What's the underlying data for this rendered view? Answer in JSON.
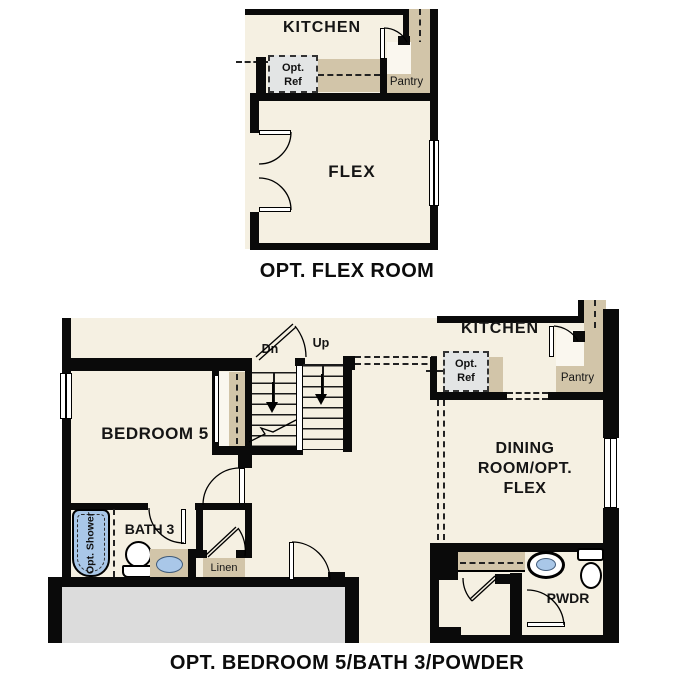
{
  "colors": {
    "floor": "#f5f0e2",
    "cabinet_tan": "#d2c5a9",
    "garage_gray": "#dcdcdc",
    "ref_box_gray": "#e3e5e5",
    "fixture_blue": "#a9c7e8",
    "wall": "#0a0a0a"
  },
  "flex_plan": {
    "kitchen_label": "KITCHEN",
    "opt_ref_line1": "Opt.",
    "opt_ref_line2": "Ref",
    "pantry_label": "Pantry",
    "flex_label": "FLEX",
    "caption": "OPT. FLEX ROOM"
  },
  "bedroom5_plan": {
    "kitchen_label": "KITCHEN",
    "opt_ref_line1": "Opt.",
    "opt_ref_line2": "Ref",
    "pantry_label": "Pantry",
    "bedroom5_label": "BEDROOM 5",
    "stairs_down_label": "Dn",
    "stairs_up_label": "Up",
    "dining_label_line1": "DINING",
    "dining_label_line2": "ROOM/OPT.",
    "dining_label_line3": "FLEX",
    "bath3_label": "BATH 3",
    "opt_shower_label": "Opt. Shower",
    "linen_label": "Linen",
    "powder_label": "PWDR",
    "caption": "OPT. BEDROOM 5/BATH 3/POWDER"
  }
}
